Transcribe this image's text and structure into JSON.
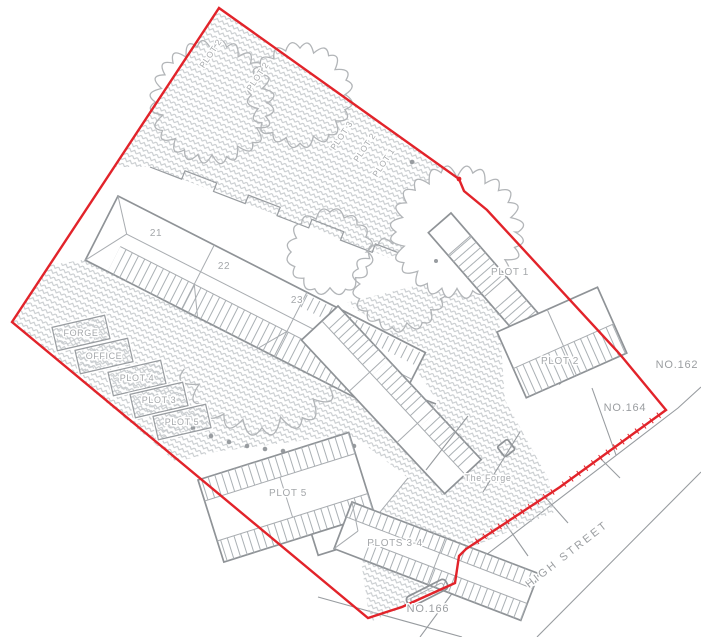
{
  "colors": {
    "boundary_red": "#e2232a",
    "line_gray": "#989ca0",
    "hatch_gray": "#c6cacd",
    "tree_gray": "#b2b5b8",
    "label_gray": "#a4a7aa"
  },
  "buildings": {
    "terrace_units": [
      {
        "label": "21"
      },
      {
        "label": "22"
      },
      {
        "label": "23"
      }
    ],
    "plot_houses": {
      "plot1": "PLOT 1",
      "plot2": "PLOT 2",
      "plot5": "PLOT 5",
      "plots34": "PLOTS 3-4"
    }
  },
  "outbuildings": [
    {
      "label": "FORGE"
    },
    {
      "label": "OFFICE"
    },
    {
      "label": "PLOT 4"
    },
    {
      "label": "PLOT 3"
    },
    {
      "label": "PLOT 5"
    }
  ],
  "garden_labels": [
    {
      "text": "PLOT 2"
    },
    {
      "text": "PLOT 2"
    },
    {
      "text": "PLOT 3"
    },
    {
      "text": "PLOT 2"
    },
    {
      "text": "PLOT 1"
    }
  ],
  "landmarks": {
    "the_forge": "The Forge"
  },
  "street": {
    "name": "HIGH STREET"
  },
  "neighbours": {
    "no162": "NO.162",
    "no164": "NO.164",
    "no166": "NO.166"
  }
}
